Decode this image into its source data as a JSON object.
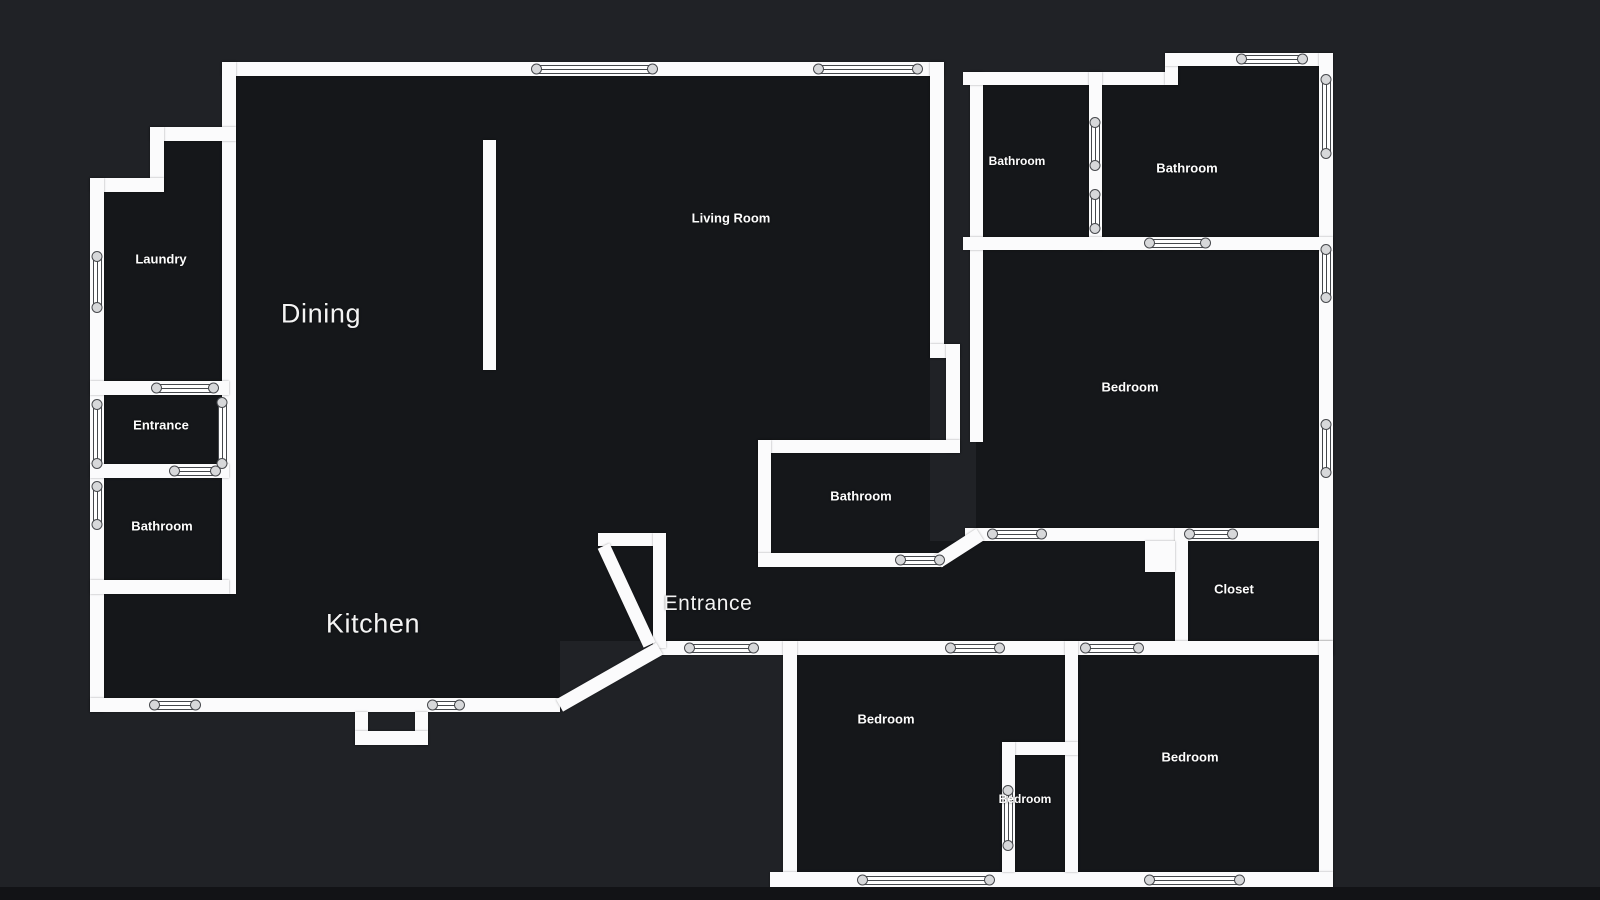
{
  "canvas": {
    "width": 1600,
    "height": 900
  },
  "colors": {
    "background": "#202226",
    "room_fill": "#15171a",
    "wall": "#fbfbfc",
    "symbol_outline": "#45484c",
    "symbol_circle_fill": "#d7d8da",
    "label_text": "#fdfdfd",
    "bottom_strip": "#121316"
  },
  "rooms": [
    {
      "id": "laundry",
      "label": "Laundry",
      "x": 161,
      "y": 259,
      "style": "bold",
      "size": 13
    },
    {
      "id": "entrance-left",
      "label": "Entrance",
      "x": 161,
      "y": 425,
      "style": "bold",
      "size": 13
    },
    {
      "id": "bathroom-left",
      "label": "Bathroom",
      "x": 162,
      "y": 526,
      "style": "bold",
      "size": 13
    },
    {
      "id": "dining",
      "label": "Dining",
      "x": 321,
      "y": 314,
      "style": "light",
      "size": 27
    },
    {
      "id": "living-room",
      "label": "Living Room",
      "x": 731,
      "y": 218,
      "style": "bold",
      "size": 13
    },
    {
      "id": "kitchen",
      "label": "Kitchen",
      "x": 373,
      "y": 624,
      "style": "light",
      "size": 27
    },
    {
      "id": "entrance-main",
      "label": "Entrance",
      "x": 708,
      "y": 604,
      "style": "light",
      "size": 21
    },
    {
      "id": "bathroom-center",
      "label": "Bathroom",
      "x": 861,
      "y": 496,
      "style": "bold",
      "size": 13
    },
    {
      "id": "bathroom-top-left",
      "label": "Bathroom",
      "x": 1017,
      "y": 161,
      "style": "bold",
      "size": 12
    },
    {
      "id": "bathroom-top-right",
      "label": "Bathroom",
      "x": 1187,
      "y": 168,
      "style": "bold",
      "size": 13
    },
    {
      "id": "bedroom-right",
      "label": "Bedroom",
      "x": 1130,
      "y": 387,
      "style": "bold",
      "size": 13
    },
    {
      "id": "closet",
      "label": "Closet",
      "x": 1234,
      "y": 589,
      "style": "bold",
      "size": 13
    },
    {
      "id": "bedroom-bottom-left",
      "label": "Bedroom",
      "x": 886,
      "y": 719,
      "style": "bold",
      "size": 13
    },
    {
      "id": "bedroom-small",
      "label": "Bedroom",
      "x": 1025,
      "y": 799,
      "style": "bold",
      "size": 12
    },
    {
      "id": "bedroom-bottom-right",
      "label": "Bedroom",
      "x": 1190,
      "y": 757,
      "style": "bold",
      "size": 13
    }
  ],
  "interiors": [
    {
      "name": "open-area-fill",
      "r": [
        236,
        76,
        694,
        565
      ]
    },
    {
      "name": "step-column-fill",
      "r": [
        164,
        141,
        58,
        240
      ]
    },
    {
      "name": "laundry-fill",
      "r": [
        104,
        192,
        118,
        189
      ]
    },
    {
      "name": "entrance-left-fill",
      "r": [
        104,
        395,
        118,
        83
      ]
    },
    {
      "name": "bathroom-left-fill",
      "r": [
        104,
        478,
        118,
        102
      ]
    },
    {
      "name": "kitchen-left-fill",
      "r": [
        104,
        594,
        132,
        104
      ]
    },
    {
      "name": "kitchen-bottom-fill",
      "r": [
        236,
        641,
        324,
        57
      ]
    },
    {
      "name": "corridor-fill",
      "r": [
        655,
        541,
        520,
        100
      ]
    },
    {
      "name": "bathrooms-top-fill",
      "r": [
        976,
        85,
        343,
        152
      ]
    },
    {
      "name": "bathroom-notch-fill",
      "r": [
        1178,
        66,
        141,
        19
      ]
    },
    {
      "name": "bedroom-right-fill",
      "r": [
        976,
        250,
        343,
        278
      ]
    },
    {
      "name": "closet-fill",
      "r": [
        1188,
        541,
        131,
        100
      ]
    },
    {
      "name": "bottom-section-fill",
      "r": [
        797,
        655,
        521,
        217
      ]
    },
    {
      "name": "nook-notch-fill",
      "r": [
        1157,
        541,
        18,
        14
      ]
    }
  ],
  "walls": [
    {
      "name": "top-wall",
      "r": [
        222,
        62,
        722,
        14
      ]
    },
    {
      "name": "left-column-wall",
      "r": [
        222,
        62,
        14,
        532
      ]
    },
    {
      "name": "step-wall-h",
      "r": [
        150,
        127,
        86,
        14
      ]
    },
    {
      "name": "step-wall-v",
      "r": [
        150,
        127,
        14,
        65
      ]
    },
    {
      "name": "laundry-top-wall",
      "r": [
        90,
        178,
        74,
        14
      ]
    },
    {
      "name": "outer-left-wall",
      "r": [
        90,
        178,
        14,
        534
      ]
    },
    {
      "name": "laundry-bottom-wall",
      "r": [
        90,
        381,
        139,
        14
      ]
    },
    {
      "name": "entrance-bottom-wall",
      "r": [
        90,
        464,
        139,
        14
      ]
    },
    {
      "name": "bathroom-bottom-wall",
      "r": [
        90,
        580,
        139,
        14
      ]
    },
    {
      "name": "kitchen-bottom-wall",
      "r": [
        90,
        698,
        470,
        14
      ]
    },
    {
      "name": "kitchen-notch-left",
      "r": [
        355,
        712,
        13,
        33
      ]
    },
    {
      "name": "kitchen-notch-right",
      "r": [
        415,
        712,
        13,
        33
      ]
    },
    {
      "name": "kitchen-notch-bottom",
      "r": [
        355,
        731,
        73,
        14
      ]
    },
    {
      "name": "dining-divider-wall",
      "r": [
        483,
        140,
        13,
        230
      ]
    },
    {
      "name": "living-right-wall",
      "r": [
        930,
        62,
        14,
        296
      ]
    },
    {
      "name": "living-jog-h",
      "r": [
        930,
        344,
        30,
        14
      ]
    },
    {
      "name": "living-jog-v",
      "r": [
        946,
        344,
        14,
        109
      ]
    },
    {
      "name": "cbath-top-wall",
      "r": [
        758,
        440,
        202,
        13
      ]
    },
    {
      "name": "cbath-left-wall",
      "r": [
        758,
        440,
        13,
        127
      ]
    },
    {
      "name": "cbath-bottom-wall",
      "r": [
        758,
        553,
        185,
        14
      ]
    },
    {
      "name": "corridor-top-wall",
      "r": [
        965,
        528,
        367,
        13
      ]
    },
    {
      "name": "closet-left-wall",
      "r": [
        1175,
        528,
        13,
        127
      ]
    },
    {
      "name": "nook-stub-wall",
      "r": [
        1145,
        541,
        30,
        31
      ]
    },
    {
      "name": "rsection-left-wall",
      "r": [
        970,
        72,
        13,
        370
      ]
    },
    {
      "name": "rtop-wall-lower",
      "r": [
        963,
        72,
        215,
        13
      ]
    },
    {
      "name": "rtop-step-wall",
      "r": [
        1165,
        53,
        13,
        32
      ]
    },
    {
      "name": "rtop-wall-upper",
      "r": [
        1165,
        53,
        167,
        13
      ]
    },
    {
      "name": "outer-right-wall",
      "r": [
        1319,
        53,
        14,
        602
      ]
    },
    {
      "name": "bathrooms-divider",
      "r": [
        1089,
        72,
        13,
        178
      ]
    },
    {
      "name": "bathrooms-bottom-wall",
      "r": [
        963,
        237,
        370,
        13
      ]
    },
    {
      "name": "corridor-bottom-wall",
      "r": [
        655,
        641,
        678,
        14
      ]
    },
    {
      "name": "bottom-left-wall",
      "r": [
        783,
        641,
        14,
        247
      ]
    },
    {
      "name": "bottom-right-wall",
      "r": [
        1319,
        641,
        14,
        247
      ]
    },
    {
      "name": "bottom-outer-wall",
      "r": [
        770,
        872,
        563,
        16
      ]
    },
    {
      "name": "bottom-divider-wall",
      "r": [
        1065,
        641,
        13,
        231
      ]
    },
    {
      "name": "small-bedroom-top",
      "r": [
        1002,
        742,
        76,
        13
      ]
    },
    {
      "name": "small-bedroom-left",
      "r": [
        1002,
        742,
        13,
        130
      ]
    },
    {
      "name": "vestibule-top-wall",
      "r": [
        598,
        533,
        68,
        13
      ]
    },
    {
      "name": "vestibule-right-wall",
      "r": [
        653,
        533,
        13,
        115
      ]
    }
  ],
  "diagonal_walls": [
    {
      "name": "kitchen-diagonal-wall",
      "x1": 560,
      "y1": 705,
      "x2": 660,
      "y2": 648,
      "t": 14
    },
    {
      "name": "vestibule-diagonal-wall",
      "x1": 604,
      "y1": 546,
      "x2": 650,
      "y2": 645,
      "t": 13
    },
    {
      "name": "cbath-corner-diagonal",
      "x1": 938,
      "y1": 561,
      "x2": 980,
      "y2": 534,
      "t": 14
    }
  ],
  "openings": [
    {
      "kind": "window",
      "o": "h",
      "cx": 594,
      "cy": 69,
      "len": 125
    },
    {
      "kind": "window",
      "o": "h",
      "cx": 868,
      "cy": 69,
      "len": 108
    },
    {
      "kind": "window",
      "o": "v",
      "cx": 97,
      "cy": 282,
      "len": 60
    },
    {
      "kind": "door",
      "o": "h",
      "cx": 185,
      "cy": 388,
      "len": 66
    },
    {
      "kind": "window",
      "o": "v",
      "cx": 97,
      "cy": 434,
      "len": 68
    },
    {
      "kind": "window",
      "o": "v",
      "cx": 222,
      "cy": 433,
      "len": 70
    },
    {
      "kind": "door",
      "o": "h",
      "cx": 195,
      "cy": 471,
      "len": 50
    },
    {
      "kind": "window",
      "o": "v",
      "cx": 97,
      "cy": 505,
      "len": 47
    },
    {
      "kind": "door",
      "o": "h",
      "cx": 175,
      "cy": 705,
      "len": 50
    },
    {
      "kind": "door",
      "o": "h",
      "cx": 446,
      "cy": 705,
      "len": 36
    },
    {
      "kind": "door",
      "o": "h",
      "cx": 920,
      "cy": 560,
      "len": 48
    },
    {
      "kind": "door",
      "o": "h",
      "cx": 1017,
      "cy": 534,
      "len": 58
    },
    {
      "kind": "door",
      "o": "h",
      "cx": 1211,
      "cy": 534,
      "len": 52
    },
    {
      "kind": "door",
      "o": "h",
      "cx": 721,
      "cy": 648,
      "len": 73
    },
    {
      "kind": "door",
      "o": "h",
      "cx": 975,
      "cy": 648,
      "len": 58
    },
    {
      "kind": "door",
      "o": "h",
      "cx": 1112,
      "cy": 648,
      "len": 62
    },
    {
      "kind": "window",
      "o": "h",
      "cx": 1272,
      "cy": 59,
      "len": 70
    },
    {
      "kind": "window",
      "o": "v",
      "cx": 1326,
      "cy": 116,
      "len": 83
    },
    {
      "kind": "window",
      "o": "v",
      "cx": 1326,
      "cy": 273,
      "len": 57
    },
    {
      "kind": "window",
      "o": "v",
      "cx": 1326,
      "cy": 448,
      "len": 57
    },
    {
      "kind": "door",
      "o": "v",
      "cx": 1095,
      "cy": 144,
      "len": 52
    },
    {
      "kind": "door",
      "o": "v",
      "cx": 1095,
      "cy": 211,
      "len": 43
    },
    {
      "kind": "door",
      "o": "h",
      "cx": 1177,
      "cy": 243,
      "len": 65
    },
    {
      "kind": "window",
      "o": "h",
      "cx": 926,
      "cy": 880,
      "len": 136
    },
    {
      "kind": "window",
      "o": "h",
      "cx": 1194,
      "cy": 880,
      "len": 99
    },
    {
      "kind": "door",
      "o": "v",
      "cx": 1008,
      "cy": 818,
      "len": 64
    }
  ]
}
